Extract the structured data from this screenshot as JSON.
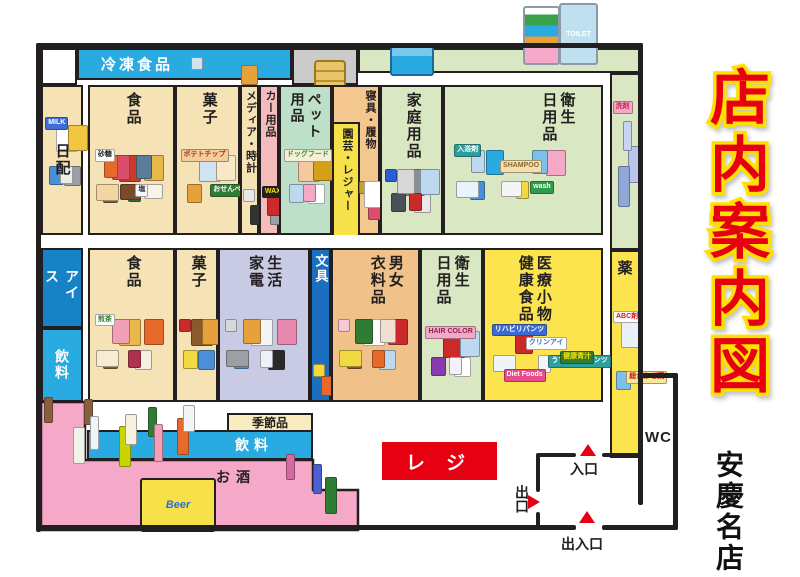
{
  "title": "店内案内図",
  "store_name": "安慶名店",
  "colors": {
    "accent_red": "#E60012",
    "title_outline_yellow": "#FFE100",
    "wall_black": "#231F20",
    "freezer_blue": "#29ABE2",
    "ice_blue": "#1583C5",
    "drink_blue": "#29ABE2",
    "cream": "#F6E3B5",
    "light_green": "#D9E8C2",
    "mint_green": "#BEE0C9",
    "pink_strip": "#F5BCBC",
    "bedding_orange": "#F3C78E",
    "garden_yellow": "#F6E14B",
    "lavender": "#C9CAE3",
    "stationery_blue": "#1B6FC0",
    "clothing_tan": "#F0C189",
    "medical_yellow": "#FBE44D",
    "seasonal_cream": "#F8EBC0",
    "sake_pink": "#F5A8C8",
    "gray_band": "#CBCBCB",
    "register_red": "#E60012"
  },
  "top_band": {
    "freezer_label": "冷凍食品",
    "freezer_items": [
      "#cfe3f2",
      "#e8a03a"
    ]
  },
  "left_strip": [
    {
      "label": "日配",
      "color": "#F6E3B5",
      "items": [
        {
          "c": "#3b6fd4",
          "t": "MILK",
          "tc": "#fff"
        },
        "#9aa0a6",
        "#ffffff",
        "#4a90d9",
        "#f2c641",
        "#e8f0e8"
      ]
    },
    {
      "label": "アイス",
      "color": "#1583C5"
    },
    {
      "label": "飲料",
      "color": "#29ABE2"
    }
  ],
  "top_row": [
    {
      "lines": [
        "食品"
      ],
      "color": "#F6E3B5",
      "items": [
        {
          "c": "#ffffff",
          "t": "砂糖"
        },
        {
          "c": "#f4f8ff",
          "t": "塩"
        },
        "#cc3a2a",
        "#8b5a2b",
        "#e8b94a",
        "#3a6b35",
        "#d94f6b",
        "#f2d8a0",
        "#5a7d9a",
        "#7a4a2a",
        "#e86a2a",
        "#f7f3e8"
      ]
    },
    {
      "lines": [
        "菓子"
      ],
      "color": "#F6E3B5",
      "items": [
        {
          "c": "#f2cf9a",
          "t": "ポテトチップ",
          "tc": "#b03020"
        },
        {
          "c": "#2e7d32",
          "t": "おせんべい",
          "tc": "#fff"
        },
        "#cfe3f2",
        "#e8a03a",
        "#f7e8c8"
      ]
    },
    {
      "lines": [
        "メディア・時計"
      ],
      "color": "#F6E3B5",
      "items": [
        "#e8e8e8",
        "#333333"
      ]
    },
    {
      "lines": [
        "カー用品"
      ],
      "color": "#F5BCBC",
      "items": [
        {
          "c": "#222222",
          "t": "WAX",
          "tc": "#ffe100"
        },
        "#9aa0a6",
        "#cc2a2a"
      ]
    },
    {
      "lines": [
        "ペット",
        "用品"
      ],
      "color": "#BEE0C9",
      "items": [
        {
          "c": "#f6efd8",
          "t": "ドッグフード",
          "tc": "#3a8a3a"
        },
        "#ffffff",
        "#f5c9a0",
        "#bcd9f0",
        "#d4a017",
        "#f5a8c8"
      ]
    },
    {
      "lines": [
        "寝具・履物"
      ],
      "color": "#F3C78E",
      "sub_label": "園芸・レジャー",
      "sub_color": "#F6E14B",
      "items": [
        "#c9a227",
        "#d94f6b",
        "#ffffff"
      ]
    },
    {
      "lines": [
        "家庭用品"
      ],
      "color": "#D9E8C2",
      "items": [
        "#2a5fd4",
        "#e8e8e8",
        "#8a8f98",
        "#4a4f58",
        "#bcd9f0",
        "#cc2a2a",
        "#d8d8d8"
      ]
    },
    {
      "lines": [
        "衛生",
        "日用品"
      ],
      "color": "#D9E8C2",
      "items": [
        {
          "c": "#2aa0a0",
          "t": "入浴剤",
          "tc": "#fff"
        },
        {
          "c": "#2e9d4a",
          "t": "wash",
          "tc": "#fff"
        },
        {
          "c": "#f2e0b0",
          "t": "SHAMPOO",
          "tc": "#8a6a2a"
        },
        "#4a90d9",
        "#f5a8c8",
        "#f2d841",
        "#29abe2",
        "#e8f4fa",
        "#7ac0e8",
        "#f5f5f5",
        "#bcd9f0"
      ]
    }
  ],
  "mid_row": [
    {
      "lines": [
        "食品"
      ],
      "color": "#F6E3B5",
      "items": [
        {
          "c": "#ffffff",
          "t": "煎茶",
          "tc": "#2e7d32"
        },
        "#f5f0e0",
        "#e8b94a",
        "#8b5a2b",
        "#e86a2a",
        "#b03050",
        "#f2a0b8",
        "#f7ecd0"
      ]
    },
    {
      "lines": [
        "菓子"
      ],
      "color": "#F6E3B5",
      "items": [
        "#cc2a2a",
        "#4a90d9",
        "#8b5a2b",
        "#f2d841",
        "#e8a03a"
      ]
    },
    {
      "lines": [
        "生活",
        "家電"
      ],
      "color": "#C9CAE3",
      "items": [
        "#d8d8d8",
        "#2a2a2a",
        "#f5f5f5",
        "#4a90d9",
        "#e88ab0",
        "#eef0f8",
        "#e8a03a",
        "#9aa0a6"
      ]
    },
    {
      "lines": [
        "文具"
      ],
      "color": "#1B6FC0",
      "items": [
        "#f2d841",
        "#e86a2a"
      ]
    },
    {
      "lines": [
        "男女",
        "衣料品"
      ],
      "color": "#F0C189",
      "items": [
        "#f5c9d8",
        "#bcd9f0",
        "#ffffff",
        "#8b5a2b",
        "#cc2a2a",
        "#e86a2a",
        "#2e7d32",
        "#f2d841",
        "#f0e0d0"
      ]
    },
    {
      "lines": [
        "衛生",
        "日用品"
      ],
      "color": "#D9E8C2",
      "items": [
        {
          "c": "#f5a8c8",
          "t": "HAIR COLOR",
          "tc": "#8a2a4a"
        },
        "#ffffff",
        "#cc2a2a",
        "#8a3ab0",
        "#bcd9f0",
        "#f5f0fa"
      ]
    },
    {
      "lines": [
        "医療小物",
        "健康食品"
      ],
      "color": "#FBE44D",
      "items": [
        {
          "c": "#3a6bd4",
          "t": "リハビリパンツ",
          "tc": "#fff"
        },
        {
          "c": "#2aa0a0",
          "t": "うす型軽快パンツ",
          "tc": "#fff"
        },
        {
          "c": "#ffffff",
          "t": "クリンアイ",
          "tc": "#2a6fd4"
        },
        {
          "c": "#e84a8a",
          "t": "Diet Foods",
          "tc": "#fff"
        },
        {
          "c": "#2e7d32",
          "t": "健康青汁",
          "tc": "#ffe100"
        },
        "#f5f5f5",
        "#cc2a2a",
        "#eef4f8"
      ]
    }
  ],
  "right_strip": {
    "green_items": [
      {
        "c": "#f5a8c8",
        "t": "洗剤",
        "tc": "#c02a5a"
      },
      "#b8c4e8",
      "#c9d4f0",
      "#8fa8d8"
    ],
    "medicine_label": "薬",
    "yellow_items": [
      {
        "c": "#ffffff",
        "t": "ABC剤",
        "tc": "#cc1a1a"
      },
      {
        "c": "#f8e89a",
        "t": "総合かぜ薬",
        "tc": "#cc1a1a"
      },
      "#e8f0f8",
      "#7ac0e8"
    ]
  },
  "bottom": {
    "seasonal_label": "季節品",
    "drinks_label": "飲料",
    "sake_label": "お酒",
    "register_label": "レ ジ",
    "beer_label": "Beer",
    "bev_items": [
      "#8b5e3c",
      "#e86a2a",
      "#2e7d32",
      "#c9d400",
      "#eef4f8",
      "#f0f6fa",
      "#f2a0b8",
      "#f5f0e0"
    ],
    "wine_items": [
      "#d46a9e",
      "#2e7d32",
      "#4a5fd0"
    ],
    "left_bottle_items": [
      "#8b5e3c",
      "#eef4e8"
    ]
  },
  "entrance": {
    "in_label": "入口",
    "out_label": "出口",
    "inout_label": "出入口",
    "wc_label": "WC"
  },
  "products": {
    "toilet": "TOILET"
  }
}
